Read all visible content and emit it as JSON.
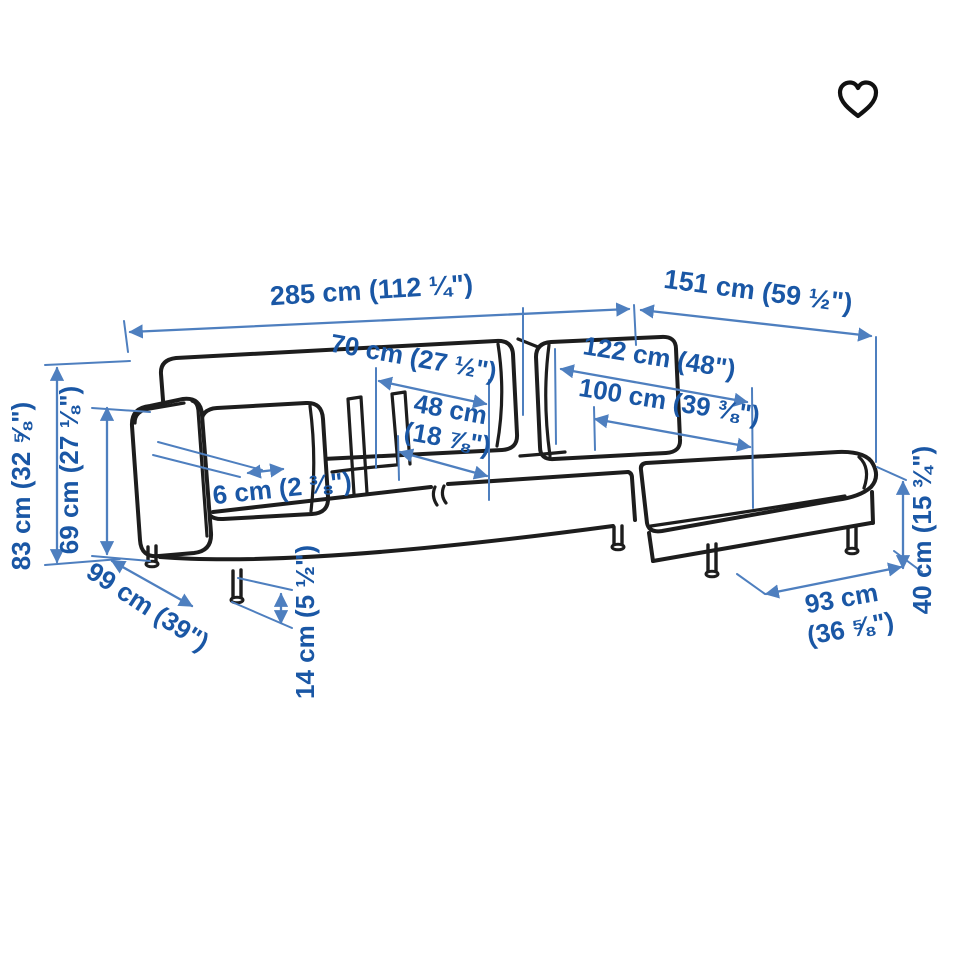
{
  "view": {
    "background_color": "#ffffff",
    "illustration": "sofa-with-chaise-longue-dimension-line-drawing"
  },
  "colors": {
    "label_blue": "#1a57a5",
    "dimension_line_blue": "#4e7fbf",
    "drawing_ink": "#1d1d1d"
  },
  "icons": {
    "favorite": "heart-outline-icon"
  },
  "dims": {
    "total_width": {
      "label": "285 cm (112 ¼\")"
    },
    "chaise_width": {
      "label": "151 cm (59 ½\")"
    },
    "seat_depth": {
      "label": "70 cm (27 ½\")"
    },
    "seat_width": {
      "label1": "48 cm",
      "label2": "(18 ⅞\")"
    },
    "chaise_length": {
      "label": "122 cm (48\")"
    },
    "chaise_seat_length": {
      "label": "100 cm (39 ⅜\")"
    },
    "armrest_width": {
      "label": "6 cm (2 ⅜\")"
    },
    "total_height": {
      "label": "83 cm (32 ⅝\")"
    },
    "armrest_height": {
      "label": "69 cm (27 ⅛\")"
    },
    "total_depth": {
      "label": "99 cm (39\")"
    },
    "leg_height": {
      "label": "14 cm (5 ½\")"
    },
    "chaise_depth": {
      "label1": "93 cm",
      "label2": "(36 ⅝\")"
    },
    "seat_height": {
      "label": "40 cm (15 ¾\")"
    }
  }
}
